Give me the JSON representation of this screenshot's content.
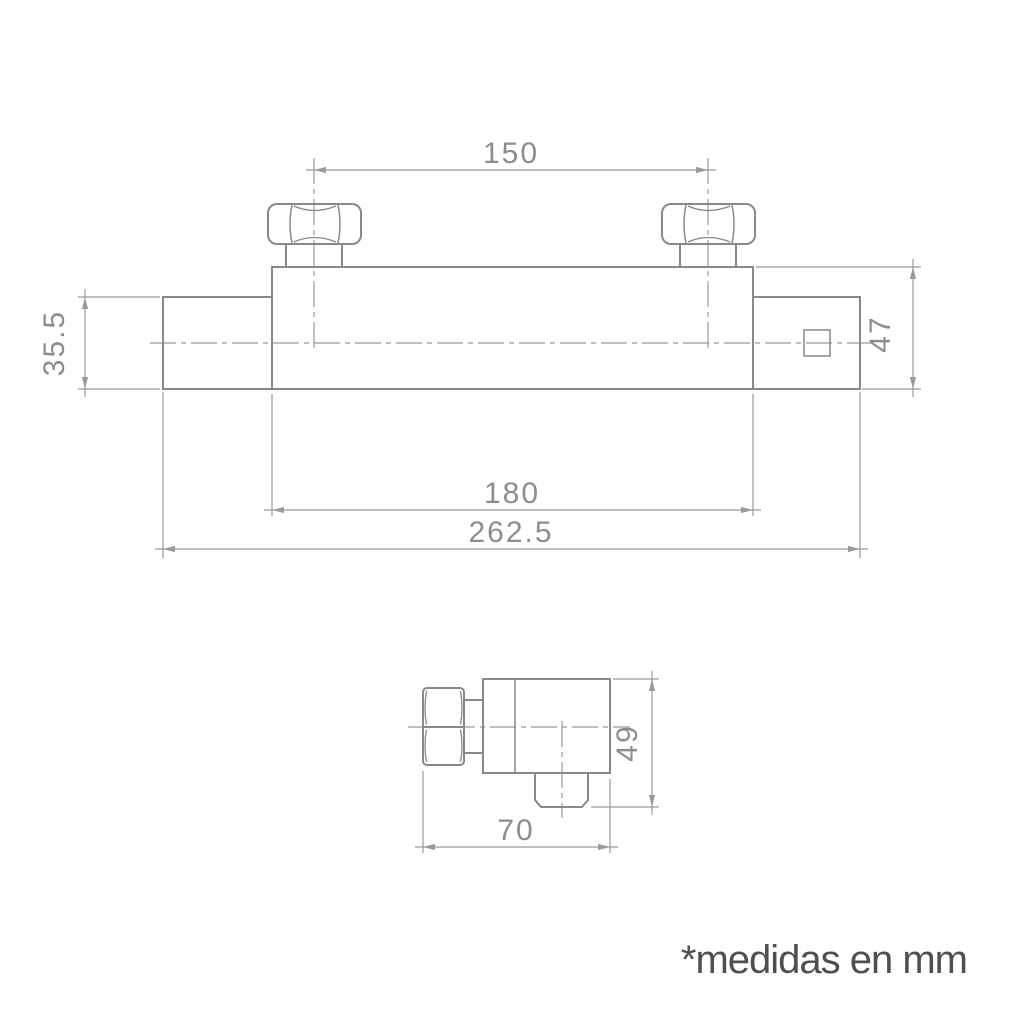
{
  "drawing": {
    "title": "thermostatic-shower-valve-dimensional-drawing",
    "units_note": "*medidas en mm",
    "front_view": {
      "dim_nut_spacing": "150",
      "dim_inlet_height": "35.5",
      "dim_body_height": "47",
      "dim_body_length": "180",
      "dim_overall_length": "262.5"
    },
    "side_view": {
      "dim_depth": "70",
      "dim_overall_height": "49"
    }
  },
  "colors": {
    "outline": "#87898c",
    "thin_line": "#97999c",
    "dim_text": "#8b8d90",
    "note_text": "#4e4f51",
    "background": "#ffffff"
  }
}
